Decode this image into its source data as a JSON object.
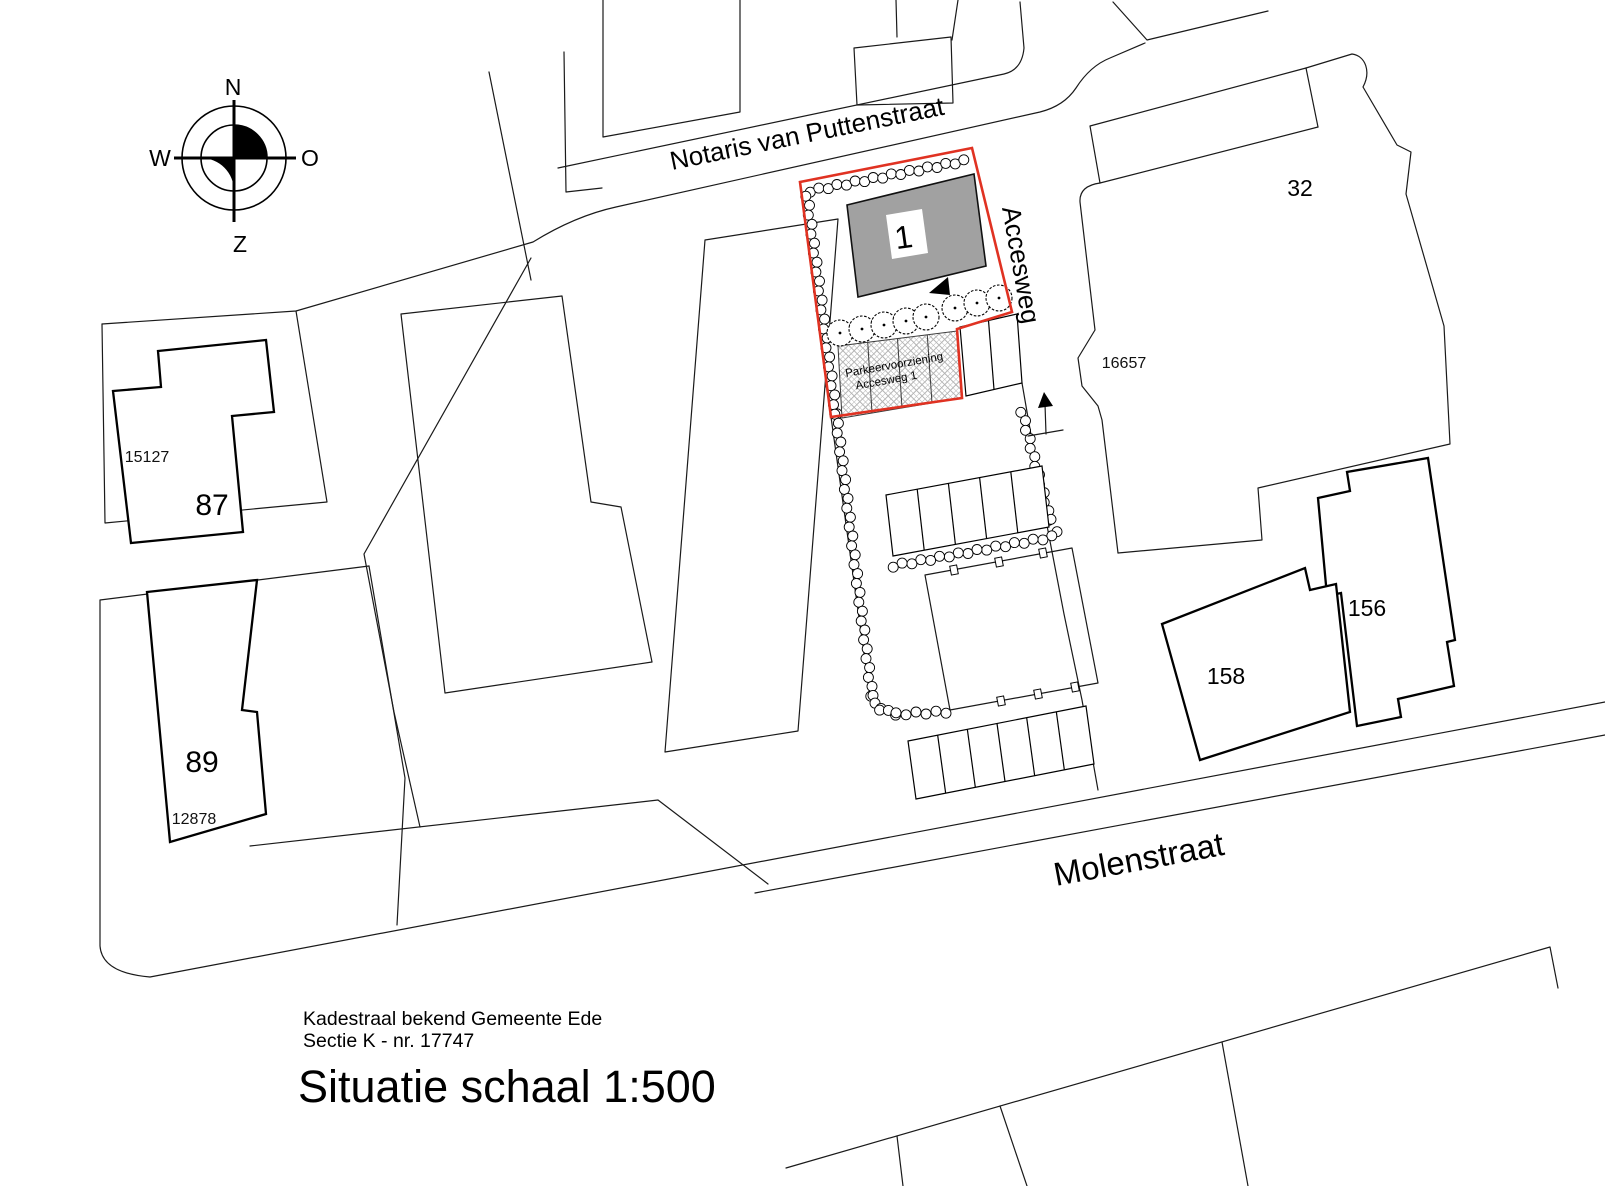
{
  "drawing": {
    "title": "Situatie schaal 1:500",
    "cadastral_note_line1": "Kadestraal bekend Gemeente Ede",
    "cadastral_note_line2": "Sectie K - nr. 17747"
  },
  "compass": {
    "n": "N",
    "o": "O",
    "z": "Z",
    "w": "W"
  },
  "streets": {
    "north": "Notaris van Puttenstraat",
    "access": "Accesweg",
    "south": "Molenstraat"
  },
  "parcels": {
    "p87": {
      "number": "87",
      "cadastral": "15127"
    },
    "p89": {
      "number": "89",
      "cadastral": "12878"
    },
    "p32": {
      "number": "32",
      "cadastral": "16657"
    },
    "p156": {
      "number": "156"
    },
    "p158": {
      "number": "158"
    }
  },
  "plot": {
    "building_label": "1",
    "parking_label_line1": "Parkeervoorziening",
    "parking_label_line2": "Accesweg 1"
  },
  "colors": {
    "plot_boundary_red": "#e03222",
    "building_gray": "#a1a1a1",
    "line_black": "#1a1a1a"
  }
}
